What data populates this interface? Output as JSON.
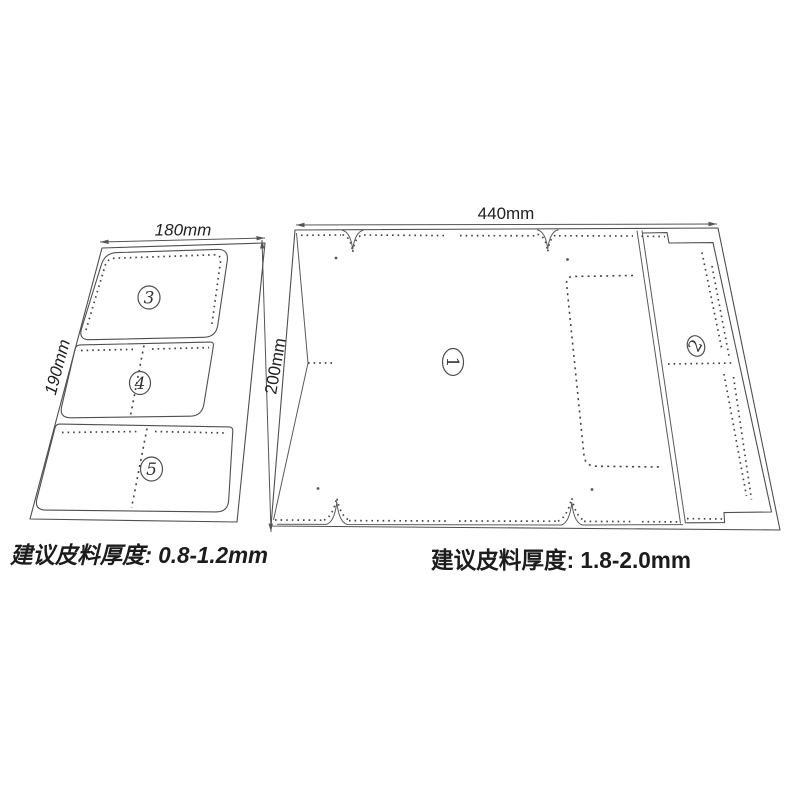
{
  "diagram": {
    "left_pattern": {
      "width_label": "180mm",
      "height_label": "190mm",
      "piece_labels": [
        "3",
        "4",
        "5"
      ],
      "note": "建议皮料厚度: 0.8-1.2mm"
    },
    "right_pattern": {
      "width_label": "440mm",
      "height_label": "200mm",
      "piece_labels": [
        "1",
        "2"
      ],
      "note": "建议皮料厚度: 1.8-2.0mm"
    }
  }
}
